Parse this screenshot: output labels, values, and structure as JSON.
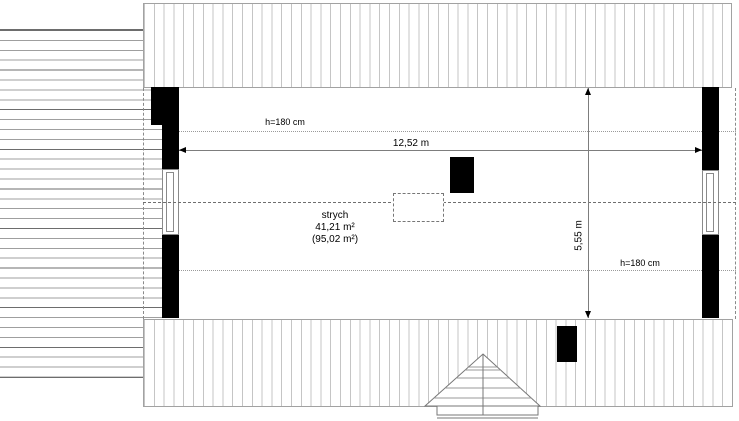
{
  "room": {
    "name": "strych",
    "area": "41,21 m²",
    "total_area": "(95,02 m²)"
  },
  "dimensions": {
    "width": "12,52 m",
    "depth": "5,55 m",
    "headroom_top": "h=180 cm",
    "headroom_bottom": "h=180 cm"
  },
  "colors": {
    "wall": "#000000",
    "roof_hatch": "#c5c5c5",
    "deck_hatch": "#9f9f9f",
    "dimension_line": "#7d7d7d"
  }
}
